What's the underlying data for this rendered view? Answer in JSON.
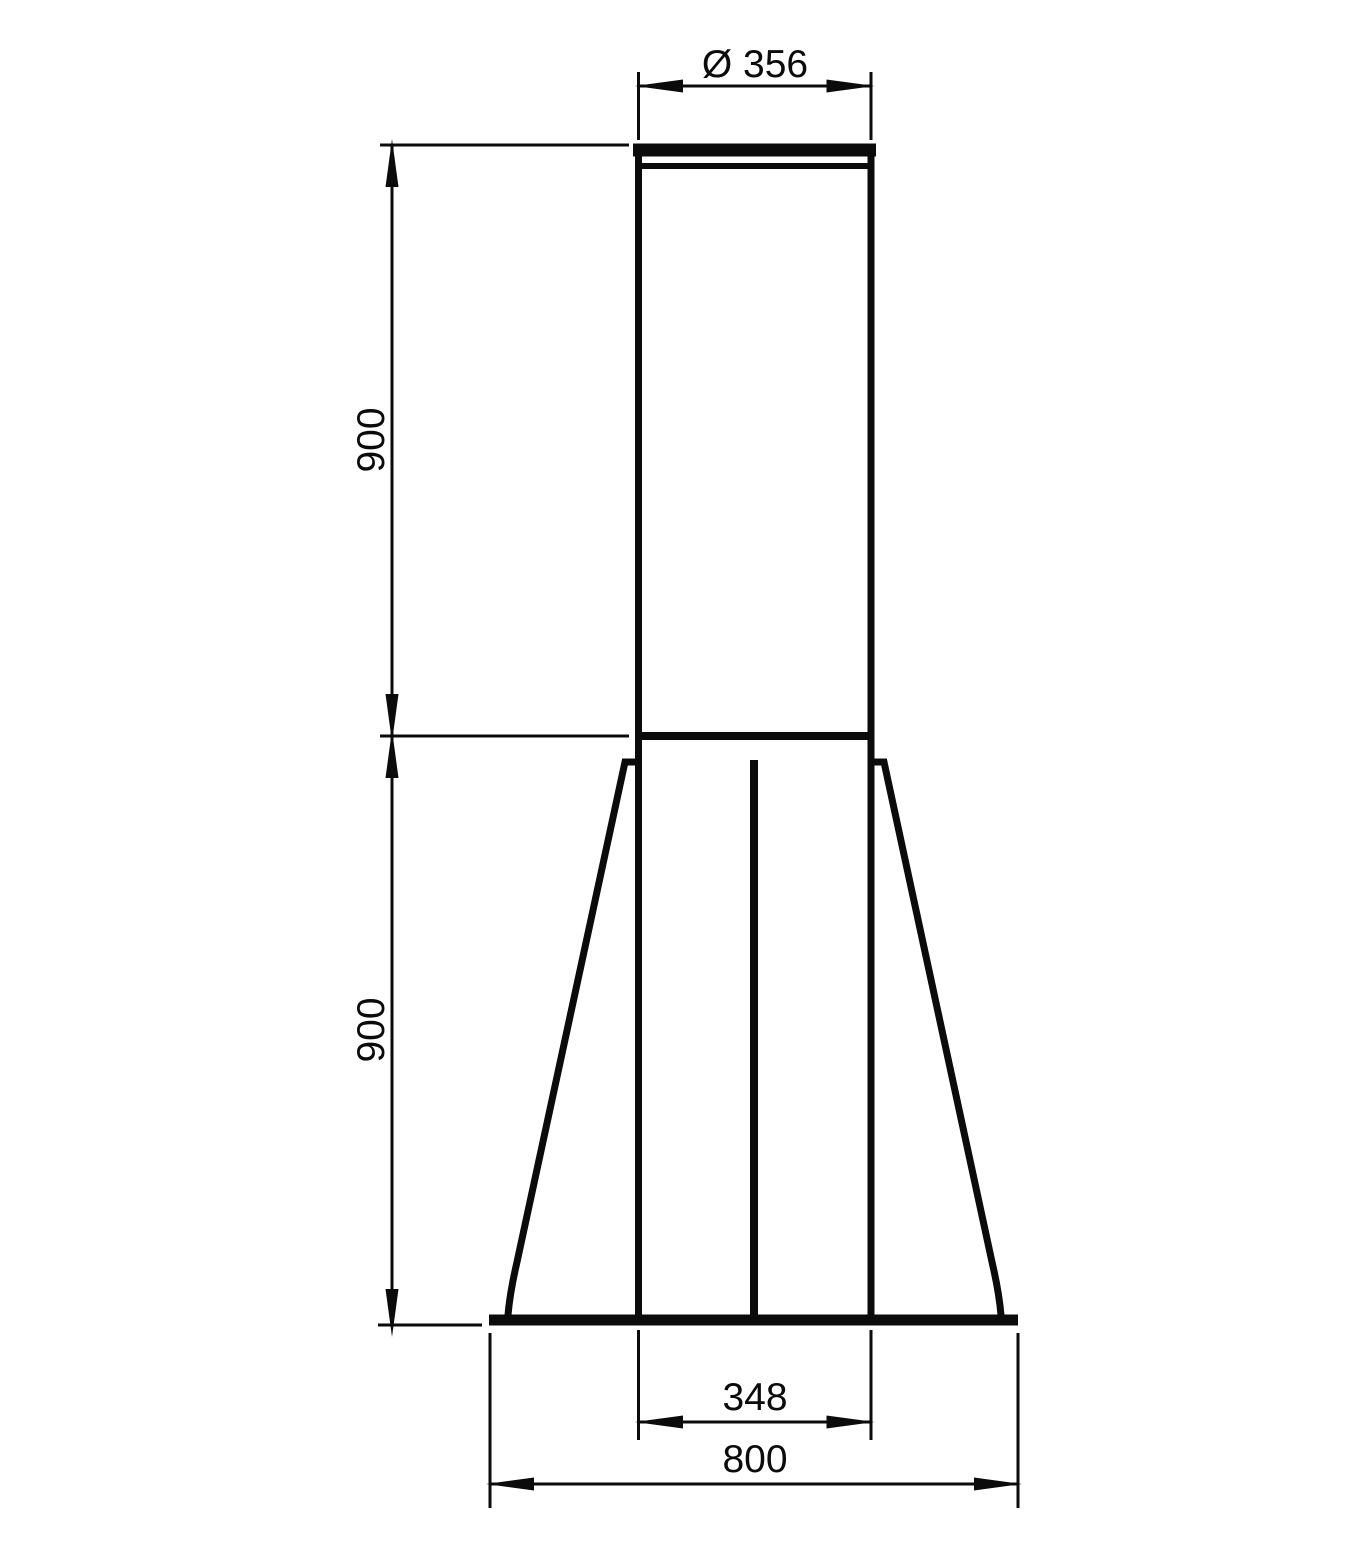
{
  "drawing": {
    "background": "#ffffff",
    "line_color": "#0b0b0b",
    "units": "mm",
    "dimensions": {
      "top_diameter": {
        "label": "Ø 356",
        "value": 356
      },
      "upper_height": {
        "label": "900",
        "value": 900
      },
      "lower_height": {
        "label": "900",
        "value": 900
      },
      "tube_width": {
        "label": "348",
        "value": 348
      },
      "base_width": {
        "label": "800",
        "value": 800
      }
    }
  }
}
